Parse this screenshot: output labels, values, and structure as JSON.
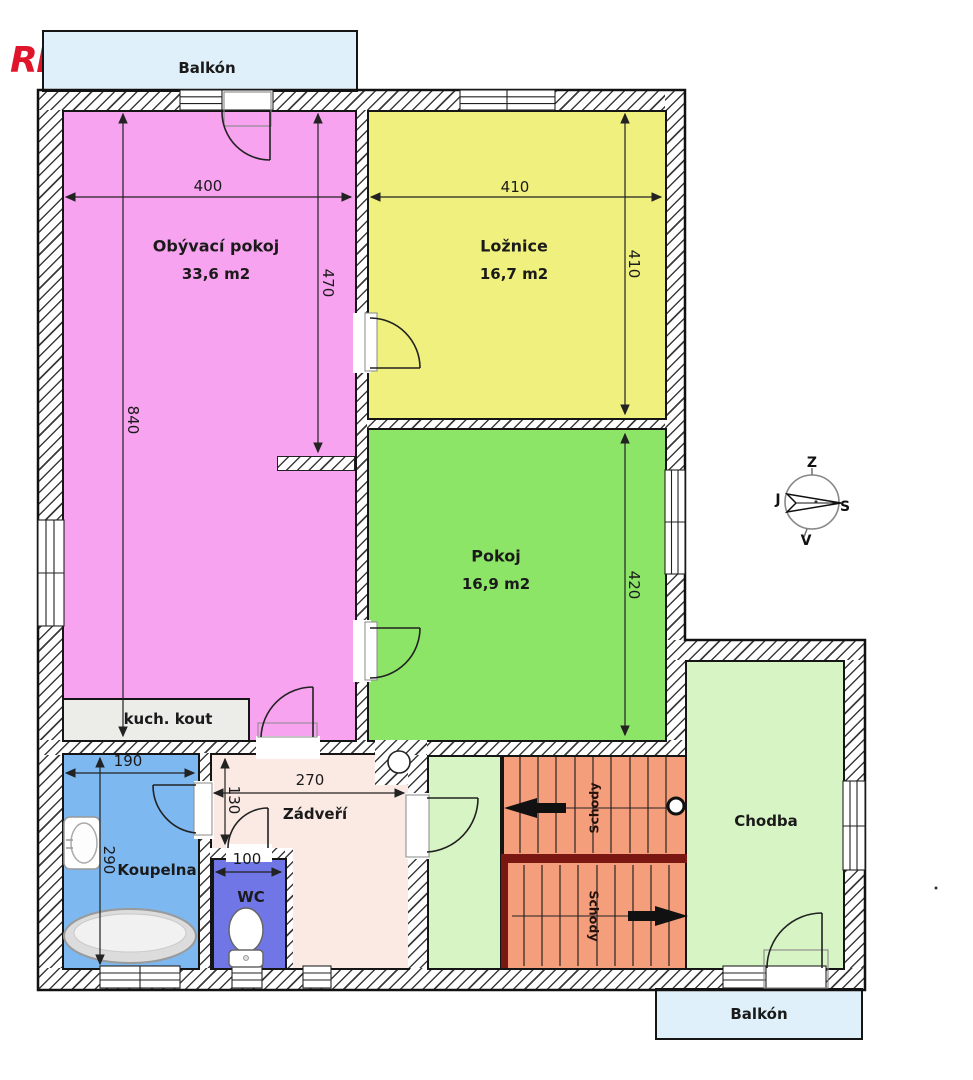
{
  "logo": {
    "re": "RE",
    "slash": "/",
    "max": "MAX"
  },
  "balconies": {
    "top": "Balkón",
    "bottom": "Balkón"
  },
  "rooms": {
    "obyvaci": {
      "name": "Obývací pokoj",
      "area": "33,6 m2"
    },
    "loznice": {
      "name": "Ložnice",
      "area": "16,7 m2"
    },
    "pokoj": {
      "name": "Pokoj",
      "area": "16,9 m2"
    },
    "koupelna": {
      "name": "Koupelna"
    },
    "wc": {
      "name": "WC"
    },
    "zadveri": {
      "name": "Zádveří"
    },
    "chodba": {
      "name": "Chodba"
    },
    "kuchyn": {
      "name": "kuch. kout"
    },
    "schody_up": "Schody",
    "schody_down": "Schody"
  },
  "dims": {
    "d400": "400",
    "d840": "840",
    "d470": "470",
    "d410w": "410",
    "d410h": "410",
    "d420": "420",
    "d190": "190",
    "d290": "290",
    "d270": "270",
    "d130": "130",
    "d100": "100"
  },
  "compass": {
    "top": "Z",
    "left": "J",
    "right": "S",
    "bottom": "V"
  },
  "colors": {
    "living": "#F7A3EF",
    "bedroom": "#EFF07D",
    "room": "#8CE566",
    "hall": "#D7F4C5",
    "bath": "#7EB8F0",
    "wc": "#7076E6",
    "entry": "#FBEAE4",
    "stairs": "#F49E7B",
    "stairs_divider": "#7A1713",
    "balcony": "#DFF0FA",
    "kitchen": "#ECECE9",
    "logo_red": "#E0152B",
    "logo_blue": "#1D3EAD"
  }
}
